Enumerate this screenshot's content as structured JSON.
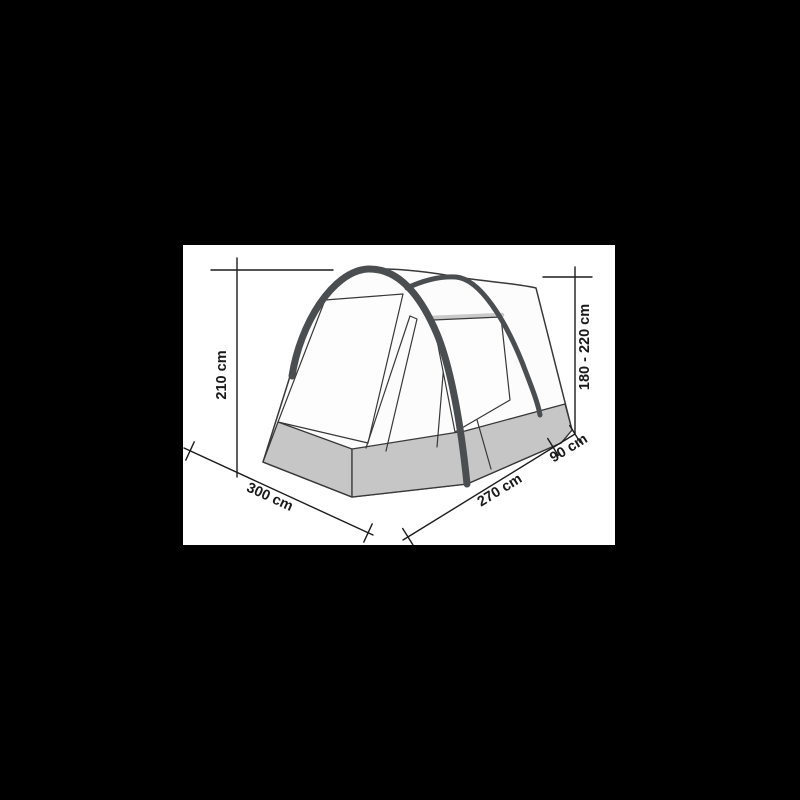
{
  "diagram": {
    "name": "tent-dimension-drawing",
    "dimensions": {
      "front_height": "210 cm",
      "rear_height_range": "180 - 220 cm",
      "width": "300 cm",
      "depth_main": "270 cm",
      "depth_extension": "90 cm"
    },
    "colors": {
      "page_background": "#000000",
      "panel_background": "#ffffff",
      "outline": "#383838",
      "dimension_lines": "#1c1c1c",
      "label_text": "#1a1a1a",
      "tent_fabric": "#fcfcfc",
      "tent_skirt": "#c6c6c6",
      "pole": "#4b4e50",
      "window_bar": "#c9c9c9"
    }
  }
}
